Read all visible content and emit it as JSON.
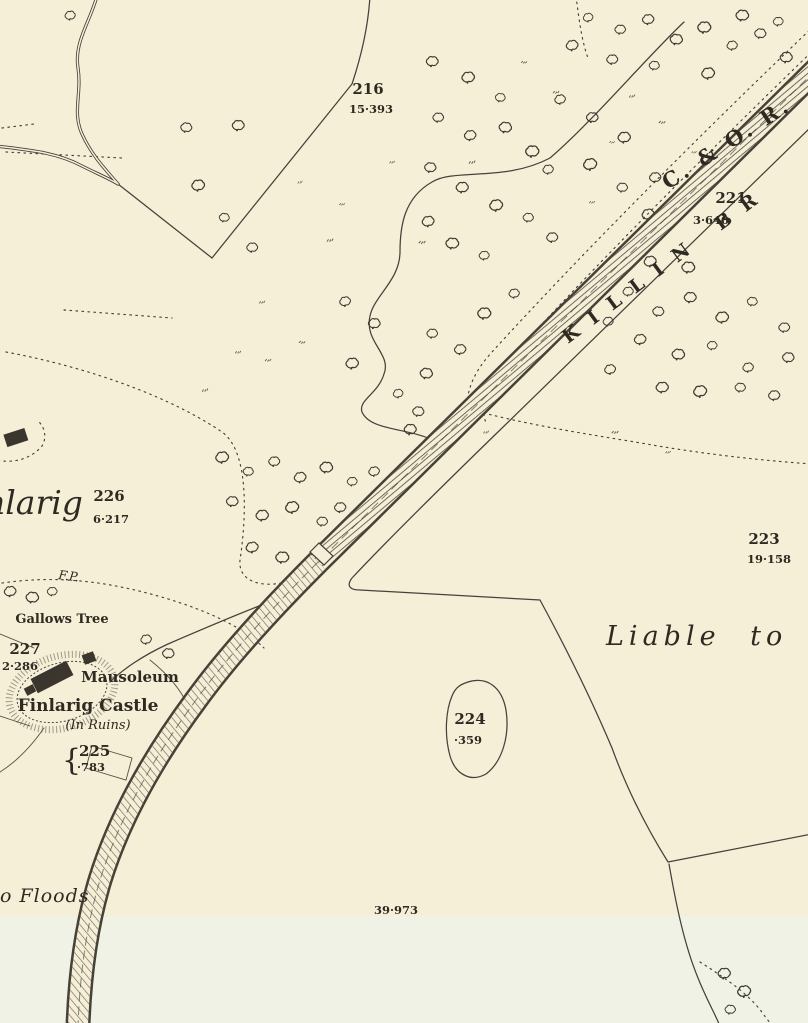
{
  "colors": {
    "paper_upper": "#f5efd8",
    "paper_lower": "#f1f2e6",
    "ink": "#3f3a31",
    "text": "#2e2a22"
  },
  "map": {
    "railway": {
      "line_name": "C. & O. R.",
      "branch_name": "KILLIN BR"
    },
    "places": {
      "finlarig_partial": "nlarig",
      "castle": "Finlarig Castle",
      "castle_condition": "(In Ruins)",
      "mausoleum": "Mausoleum",
      "gallows_tree": "Gallows Tree",
      "footpath_abbrev": "F.P.",
      "liable_to_floods_right": "Liable to",
      "liable_to_floods_bottom": "o Floods"
    },
    "parcels": [
      {
        "number": "216",
        "area": "15·393"
      },
      {
        "number": "221",
        "area": "3·640"
      },
      {
        "number": "223",
        "area": "19·158"
      },
      {
        "number": "224",
        "area": "·359"
      },
      {
        "number": "225",
        "area": "·783"
      },
      {
        "number": "226",
        "area": "6·217"
      },
      {
        "number": "227",
        "area": "2·286"
      }
    ],
    "area_value_bottom": "39·973",
    "brace_glyph": "{"
  }
}
